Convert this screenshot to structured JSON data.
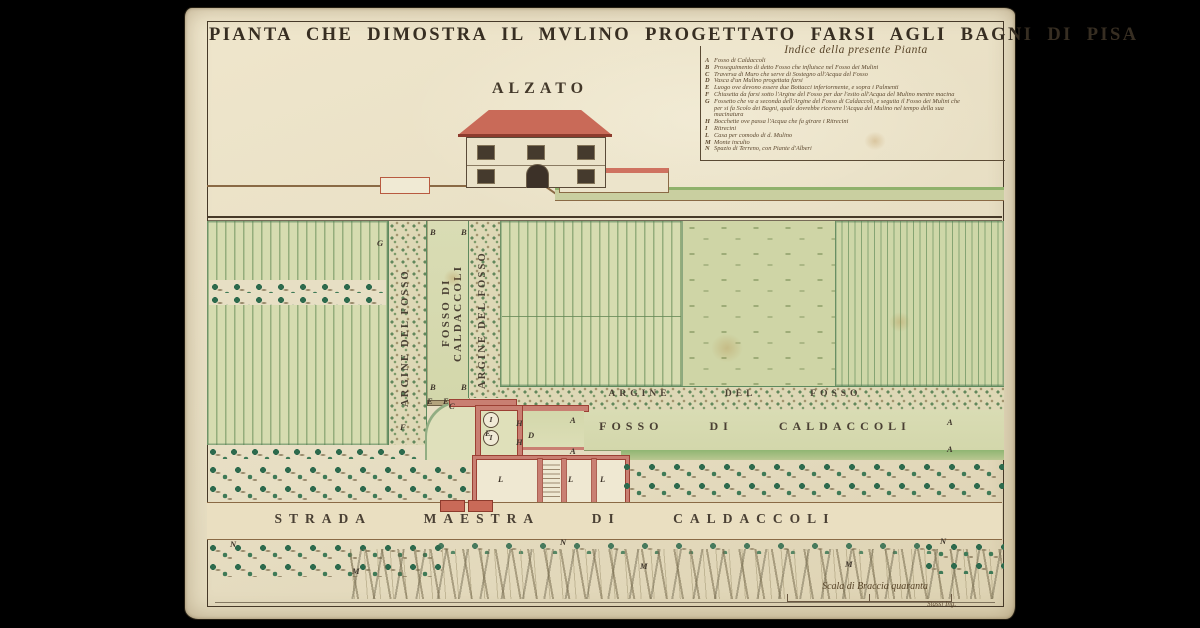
{
  "plate": {
    "title": "PIANTA CHE DIMOSTRA IL MVLINO PROGETTATO FARSI AGLI BAGNI DI PISA",
    "number": "XXII"
  },
  "index": {
    "title": "Indice della presente Pianta",
    "items": [
      {
        "key": "A",
        "text": "Fosso di Caldaccoli"
      },
      {
        "key": "B",
        "text": "Proseguimento di detto Fosso che influisce nel Fosso dei Mulini"
      },
      {
        "key": "C",
        "text": "Traversa di Muro che serve di Sostegno all'Acqua del Fosso"
      },
      {
        "key": "D",
        "text": "Vasca d'un Mulino progettata farsi"
      },
      {
        "key": "E",
        "text": "Luogo ove devono essere due Bottacci inferiormente, e sopra i Palmenti"
      },
      {
        "key": "F",
        "text": "Chiusetta da farsi sotto l'Argine del Fosso per dar l'esito all'Acqua del Mulino mentre macina"
      },
      {
        "key": "G",
        "text": "Fossetto che va a seconda dell'Argine del Fosso di Caldaccoli, e seguita il Fosso dei Mulini che per si fa Scolo dei Bagni, quale dovrebbe ricevere l'Acqua del Mulino nel tempo della sua macinatura"
      },
      {
        "key": "H",
        "text": "Bocchette ove passa l'Acqua che fa girare i Ritrecini"
      },
      {
        "key": "I",
        "text": "Ritrecini"
      },
      {
        "key": "L",
        "text": "Casa per comodo di d. Mulino"
      },
      {
        "key": "M",
        "text": "Monte inculto"
      },
      {
        "key": "N",
        "text": "Spazio di Terreno, con Piante d'Alberi"
      }
    ]
  },
  "elevation": {
    "label": "ALZATO"
  },
  "plan": {
    "label": "PIANTA",
    "vertical_bank_left": "ARGINE DEL FOSSO",
    "vertical_canal": "FOSSO DI CALDACCOLI",
    "vertical_bank_right": "ARGINE DEL FOSSO",
    "horizontal_bank": "ARGINE DEL FOSSO",
    "horizontal_canal": "FOSSO DI CALDACCOLI",
    "road": "STRADA MAESTRA DI CALDACCOLI",
    "wheel_label": "I",
    "markers": [
      {
        "label": "B",
        "x": 245,
        "y": 219
      },
      {
        "label": "B",
        "x": 276,
        "y": 219
      },
      {
        "label": "G",
        "x": 192,
        "y": 230
      },
      {
        "label": "B",
        "x": 245,
        "y": 374
      },
      {
        "label": "B",
        "x": 276,
        "y": 374
      },
      {
        "label": "E",
        "x": 242,
        "y": 388
      },
      {
        "label": "E",
        "x": 258,
        "y": 388
      },
      {
        "label": "C",
        "x": 264,
        "y": 393
      },
      {
        "label": "F",
        "x": 215,
        "y": 414
      },
      {
        "label": "E",
        "x": 300,
        "y": 420
      },
      {
        "label": "H",
        "x": 331,
        "y": 410
      },
      {
        "label": "H",
        "x": 331,
        "y": 429
      },
      {
        "label": "D",
        "x": 343,
        "y": 422
      },
      {
        "label": "A",
        "x": 385,
        "y": 407
      },
      {
        "label": "A",
        "x": 385,
        "y": 438
      },
      {
        "label": "A",
        "x": 762,
        "y": 409
      },
      {
        "label": "A",
        "x": 762,
        "y": 436
      },
      {
        "label": "L",
        "x": 313,
        "y": 466
      },
      {
        "label": "L",
        "x": 383,
        "y": 466
      },
      {
        "label": "L",
        "x": 415,
        "y": 466
      },
      {
        "label": "N",
        "x": 45,
        "y": 531
      },
      {
        "label": "N",
        "x": 375,
        "y": 529
      },
      {
        "label": "N",
        "x": 755,
        "y": 528
      },
      {
        "label": "M",
        "x": 167,
        "y": 558
      },
      {
        "label": "M",
        "x": 455,
        "y": 553
      },
      {
        "label": "M",
        "x": 660,
        "y": 551
      }
    ]
  },
  "scale": {
    "label": "Scala di Braccia quaranta",
    "signature": "Stassi Ing."
  },
  "colors": {
    "paper": "#e9e0c6",
    "ink": "#3e342a",
    "plate_number_red": "#b1572f",
    "field_green": "#d6dcb0",
    "tree_green": "#2d6a4d",
    "wall_pink": "#c97f72",
    "roof_red": "#c96a58",
    "water_green": "#d8dbb2",
    "road_line_brown": "#8a6a45"
  }
}
